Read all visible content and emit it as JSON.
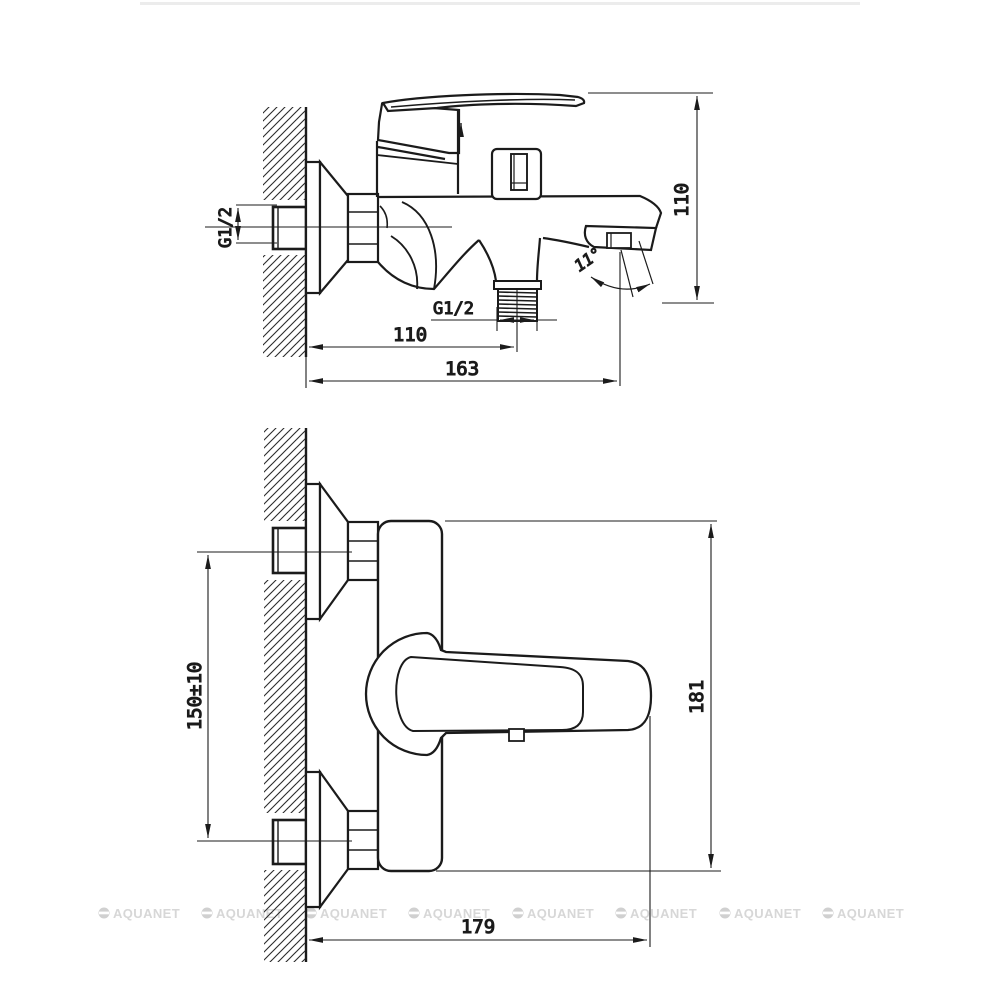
{
  "drawing": {
    "type": "technical-dimension-drawing",
    "subject": "wall-mounted bath mixer faucet, side view (top) and front view (bottom)",
    "line_color": "#1b1b1b",
    "top_view": {
      "wall_thread_label": "G1/2",
      "shower_outlet_thread_label": "G1/2",
      "wall_to_shower_outlet_dim": "110",
      "total_projection_dim": "163",
      "body_height_dim": "110",
      "spout_angle_dim": "11°"
    },
    "front_view": {
      "hole_centers_dim": "150±10",
      "overall_height_dim": "181",
      "overall_width_dim": "179"
    }
  },
  "watermark": {
    "text": "AQUANET",
    "color": "#d7d7d7",
    "icon": "circle-with-bar-icon",
    "count": 8
  }
}
